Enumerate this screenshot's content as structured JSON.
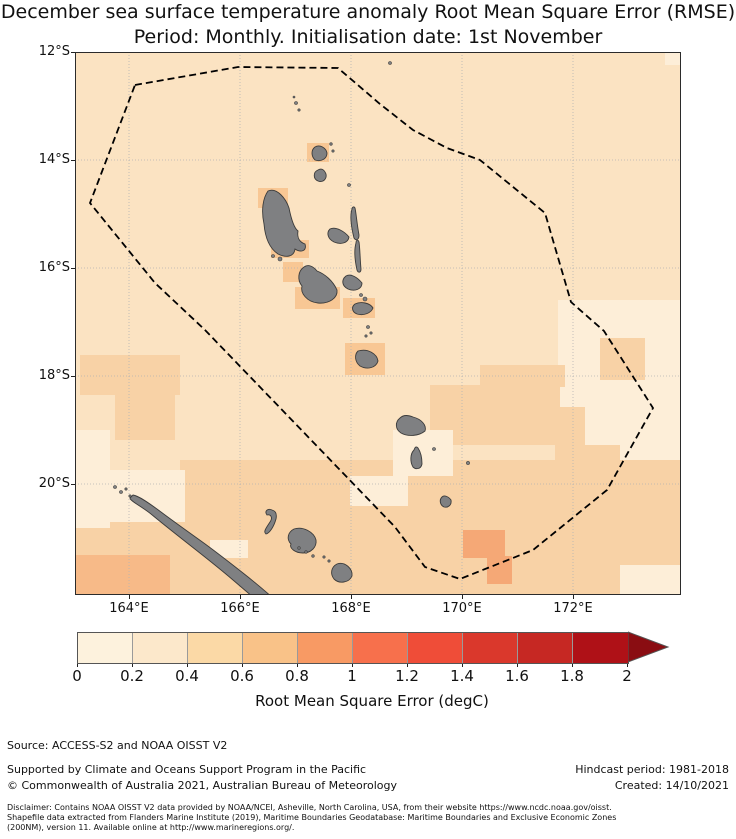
{
  "title": {
    "line1": "December sea surface temperature anomaly Root Mean Square Error (RMSE)",
    "line2": "Period: Monthly. Initialisation date: 1st November"
  },
  "footer": {
    "source": "Source: ACCESS-S2 and NOAA OISST V2",
    "supported": "Supported by Climate and Oceans Support Program in the Pacific",
    "copyright": "© Commonwealth of Australia 2021, Australian Bureau of Meteorology",
    "hindcast": "Hindcast period: 1981-2018",
    "created": "Created: 14/10/2021",
    "disclaimer_line1": "Disclaimer: Contains NOAA OISST V2 data provided by NOAA/NCEI, Asheville, North Carolina, USA, from their website https://www.ncdc.noaa.gov/oisst.",
    "disclaimer_line2": "Shapefile data extracted from Flanders Marine Institute (2019), Maritime Boundaries Geodatabase: Maritime Boundaries and Exclusive Economic Zones",
    "disclaimer_line3": "(200NM), version 11. Available online at http://www.marineregions.org/."
  },
  "chart_data": {
    "type": "heatmap",
    "subtype": "geographic-rmse-map",
    "title": "December sea surface temperature anomaly Root Mean Square Error (RMSE)",
    "subtitle": "Period: Monthly. Initialisation date: 1st November",
    "x_ticks": [
      "164°E",
      "166°E",
      "168°E",
      "170°E",
      "172°E"
    ],
    "y_ticks": [
      "12°S",
      "14°S",
      "16°S",
      "18°S",
      "20°S"
    ],
    "xlim": [
      "163°E",
      "174°E"
    ],
    "ylim": [
      "22°S",
      "12°S"
    ],
    "grid": true,
    "boundary": "dashed black EEZ polygon",
    "colorbar": {
      "label": "Root Mean Square Error (degC)",
      "ticks": [
        "0",
        "0.2",
        "0.4",
        "0.6",
        "0.8",
        "1",
        "1.2",
        "1.4",
        "1.6",
        "1.8",
        "2"
      ],
      "bin_colors": [
        "#fdf2dd",
        "#fce8cb",
        "#fbd9a6",
        "#f9c288",
        "#f89a64",
        "#f7704c",
        "#ef4d38",
        "#da382c",
        "#c62823",
        "#af1117"
      ],
      "arrow_color": "#8a0d12",
      "extend": "max"
    },
    "field_summary": [
      {
        "region": "most of map (ocean around Vanuatu)",
        "rmse_bin": "0.2-0.4"
      },
      {
        "region": "east of EEZ boundary and scattered coastal cells",
        "rmse_bin": "0-0.2"
      },
      {
        "region": "southern third of map, west 18S cluster, central 18-19.5S region",
        "rmse_bin": "0.4-0.6"
      },
      {
        "region": "grid cells hugging the main islands",
        "rmse_bin": "0.6-0.8"
      },
      {
        "region": "small patch near 170.5E 21S",
        "rmse_bin": "0.8-1"
      }
    ]
  },
  "map_geometry": {
    "units": "pixels inside 606x543 map box (origin at page 75,52)",
    "base_color": "#fbe3c2",
    "island_fill": "#7f8082",
    "island_stroke": "#3b3b3b",
    "grid_color": "#b3b3b3",
    "border_color": "#2b2b2b",
    "eez_color": "#000000",
    "gridlines": {
      "x": [
        54,
        165,
        276,
        387,
        498
      ],
      "y": [
        108,
        216,
        324,
        432
      ]
    },
    "xtick_px": [
      129,
      240,
      351,
      462,
      573
    ],
    "ytick_px": [
      52,
      160,
      268,
      376,
      484
    ],
    "eez_boundary": [
      [
        60,
        33
      ],
      [
        163,
        15
      ],
      [
        263,
        16
      ],
      [
        305,
        52
      ],
      [
        338,
        78
      ],
      [
        372,
        96
      ],
      [
        405,
        108
      ],
      [
        470,
        161
      ],
      [
        496,
        250
      ],
      [
        529,
        279
      ],
      [
        578,
        356
      ],
      [
        532,
        438
      ],
      [
        458,
        498
      ],
      [
        385,
        527
      ],
      [
        350,
        515
      ],
      [
        320,
        475
      ],
      [
        130,
        278
      ],
      [
        80,
        231
      ],
      [
        15,
        151
      ]
    ],
    "patches": [
      {
        "name": "cream-east-of-eez",
        "x": 483,
        "y": 248,
        "w": 123,
        "h": 175,
        "color": "#fdeed8",
        "bin": "0-0.2"
      },
      {
        "name": "band-south",
        "x": 0,
        "y": 448,
        "w": 606,
        "h": 95,
        "color": "#f8d2a6",
        "bin": "0.4-0.6"
      },
      {
        "name": "band-south-upper",
        "x": 105,
        "y": 408,
        "w": 501,
        "h": 40,
        "color": "#f8d2a6",
        "bin": "0.4-0.6"
      },
      {
        "name": "central-eez-patch",
        "x": 355,
        "y": 333,
        "w": 130,
        "h": 60,
        "color": "#f8d2a6",
        "bin": "0.4-0.6"
      },
      {
        "name": "central-eez-patch-top",
        "x": 405,
        "y": 313,
        "w": 85,
        "h": 22,
        "color": "#f8d2a6",
        "bin": "0.4-0.6"
      },
      {
        "name": "west-cluster-a",
        "x": 5,
        "y": 303,
        "w": 100,
        "h": 40,
        "color": "#f8d2a6",
        "bin": "0.4-0.6"
      },
      {
        "name": "west-cluster-b",
        "x": 40,
        "y": 338,
        "w": 60,
        "h": 50,
        "color": "#f8d2a6",
        "bin": "0.4-0.6"
      },
      {
        "name": "east-patch-17s",
        "x": 525,
        "y": 286,
        "w": 45,
        "h": 42,
        "color": "#f8d2a6",
        "bin": "0.4-0.6"
      },
      {
        "name": "east-step-a",
        "x": 480,
        "y": 355,
        "w": 30,
        "h": 88,
        "color": "#f8d2a6",
        "bin": "0.4-0.6"
      },
      {
        "name": "east-step-b",
        "x": 510,
        "y": 393,
        "w": 35,
        "h": 50,
        "color": "#f8d2a6",
        "bin": "0.4-0.6"
      },
      {
        "name": "cream-west-edge",
        "x": 0,
        "y": 378,
        "w": 35,
        "h": 98,
        "color": "#fdeed8",
        "bin": "0-0.2"
      },
      {
        "name": "cream-nw-new-caledonia",
        "x": 35,
        "y": 418,
        "w": 75,
        "h": 52,
        "color": "#fdeed8",
        "bin": "0-0.2"
      },
      {
        "name": "cream-south-erromango",
        "x": 318,
        "y": 378,
        "w": 60,
        "h": 46,
        "color": "#fdeed8",
        "bin": "0-0.2"
      },
      {
        "name": "cream-south-erromango-b",
        "x": 275,
        "y": 424,
        "w": 58,
        "h": 30,
        "color": "#fdeed8",
        "bin": "0-0.2"
      },
      {
        "name": "cream-bottom-right",
        "x": 545,
        "y": 513,
        "w": 61,
        "h": 30,
        "color": "#fdeed8",
        "bin": "0-0.2"
      },
      {
        "name": "cream-near-nc",
        "x": 135,
        "y": 488,
        "w": 38,
        "h": 18,
        "color": "#fdeed8",
        "bin": "0-0.2"
      },
      {
        "name": "cream-top-right",
        "x": 590,
        "y": 0,
        "w": 16,
        "h": 13,
        "color": "#fdeed8",
        "bin": "0-0.2"
      },
      {
        "name": "orange-south-tanna-a",
        "x": 388,
        "y": 478,
        "w": 42,
        "h": 28,
        "color": "#f5a876",
        "bin": "0.8-1"
      },
      {
        "name": "orange-south-tanna-b",
        "x": 412,
        "y": 504,
        "w": 25,
        "h": 28,
        "color": "#f5a876",
        "bin": "0.8-1"
      },
      {
        "name": "orange-bottom-left",
        "x": 0,
        "y": 503,
        "w": 95,
        "h": 40,
        "color": "#f7ba88",
        "bin": "0.6-0.8"
      },
      {
        "name": "cell-vanua-lava",
        "x": 232,
        "y": 91,
        "w": 22,
        "h": 19,
        "color": "#f8c794",
        "bin": "0.6-0.8"
      },
      {
        "name": "cell-santo-nw",
        "x": 183,
        "y": 136,
        "w": 30,
        "h": 20,
        "color": "#f8c794",
        "bin": "0.6-0.8"
      },
      {
        "name": "cell-santo-s",
        "x": 196,
        "y": 188,
        "w": 38,
        "h": 18,
        "color": "#f8c794",
        "bin": "0.6-0.8"
      },
      {
        "name": "cell-malakula-w",
        "x": 208,
        "y": 210,
        "w": 20,
        "h": 20,
        "color": "#f8c794",
        "bin": "0.6-0.8"
      },
      {
        "name": "cell-malakula-s",
        "x": 220,
        "y": 235,
        "w": 45,
        "h": 22,
        "color": "#f8c794",
        "bin": "0.6-0.8"
      },
      {
        "name": "cell-epi",
        "x": 268,
        "y": 246,
        "w": 32,
        "h": 20,
        "color": "#f8c794",
        "bin": "0.6-0.8"
      },
      {
        "name": "cell-efate",
        "x": 270,
        "y": 291,
        "w": 40,
        "h": 32,
        "color": "#f8c794",
        "bin": "0.6-0.8"
      }
    ],
    "islands": [
      {
        "name": "vanua-lava",
        "d": "M240,95 C236,98 236,104 240,108 C246,110 252,107 252,101 C251,96 245,92 240,95 Z"
      },
      {
        "name": "gaua",
        "d": "M243,118 C238,120 238,127 243,129 C248,131 252,127 251,122 C249,117 246,116 243,118 Z"
      },
      {
        "name": "espiritu-santo",
        "d": "M193,139 C188,146 186,158 189,172 C190,184 194,196 203,202 C211,206 219,205 220,197 C226,201 232,199 230,192 C224,190 222,185 223,179 C219,176 216,166 214,156 C211,147 202,135 193,139 Z"
      },
      {
        "name": "ambae",
        "d": "M255,177 C251,181 253,187 259,190 C266,193 273,191 274,185 C270,180 261,174 255,177 Z"
      },
      {
        "name": "maewo",
        "d": "M277,157 C275,163 276,174 279,186 C281,189 284,188 284,183 C282,172 281,160 280,156 C279,154 277,155 277,157 Z"
      },
      {
        "name": "pentecost",
        "d": "M281,191 C279,198 280,209 282,218 C283,221 286,221 286,217 C285,207 285,196 284,190 C283,187 281,188 281,191 Z"
      },
      {
        "name": "malakula",
        "d": "M229,215 C223,219 222,228 227,234 C225,241 232,250 243,251 C254,252 263,246 262,238 C258,229 250,222 242,219 C238,214 233,212 229,215 Z"
      },
      {
        "name": "ambrym",
        "d": "M271,224 C266,228 267,234 273,237 C280,240 287,237 287,231 C283,226 276,221 271,224 Z"
      },
      {
        "name": "epi",
        "d": "M280,252 C276,255 277,260 282,262 C289,264 296,261 298,256 C295,251 286,249 280,252 Z"
      },
      {
        "name": "efate",
        "d": "M283,299 C279,303 280,310 285,314 C292,318 301,316 303,309 C302,302 293,296 283,299 Z"
      },
      {
        "name": "erromango",
        "d": "M325,366 C320,370 320,377 326,381 C333,385 344,384 350,379 C352,373 346,367 338,365 C333,363 328,363 325,366 Z"
      },
      {
        "name": "tanna",
        "d": "M339,398 C335,402 335,410 338,415 C341,418 346,417 347,412 C347,405 345,399 343,396 C341,394 340,395 339,398 Z"
      },
      {
        "name": "aneityum",
        "d": "M367,445 C364,448 365,453 369,455 C373,456 377,453 376,448 C373,444 369,443 367,445 Z"
      },
      {
        "name": "new-caledonia",
        "d": "M58,443 C64,444 74,451 86,460 C98,469 112,479 126,489 C140,499 154,510 168,521 C182,532 196,544 208,555 L212,560 L198,562 C186,552 172,540 158,528 C144,516 130,505 116,494 C102,483 88,472 76,462 C66,454 55,449 55,446 Z"
      },
      {
        "name": "ouvea",
        "d": "M197,458 C193,456 189,459 192,463 C196,462 198,466 195,470 C191,476 188,480 191,482 C195,481 199,474 201,467 C202,462 201,459 197,458 Z"
      },
      {
        "name": "lifou",
        "d": "M219,477 C213,480 211,487 216,492 C214,496 220,501 228,501 C236,501 242,495 241,488 C239,480 228,474 219,477 Z"
      },
      {
        "name": "mare",
        "d": "M262,512 C256,515 255,522 259,527 C264,532 274,531 277,524 C278,517 270,509 262,512 Z"
      },
      {
        "name": "torres-islet-a",
        "cx": 221,
        "cy": 51,
        "r": 1.5
      },
      {
        "name": "torres-islet-b",
        "cx": 224,
        "cy": 58,
        "r": 1.2
      },
      {
        "name": "torres-islet-c",
        "cx": 219,
        "cy": 45,
        "r": 1.0
      },
      {
        "name": "hiu-islet",
        "cx": 315,
        "cy": 11,
        "r": 1.5
      },
      {
        "name": "mota-lava-a",
        "cx": 256,
        "cy": 92,
        "r": 1.3
      },
      {
        "name": "mota-lava-b",
        "cx": 258,
        "cy": 99,
        "r": 1.2
      },
      {
        "name": "mere-lava",
        "cx": 274,
        "cy": 133,
        "r": 1.5
      },
      {
        "name": "malo-a",
        "cx": 205,
        "cy": 207,
        "r": 2
      },
      {
        "name": "malo-b",
        "cx": 198,
        "cy": 204,
        "r": 1.5
      },
      {
        "name": "paama",
        "cx": 286,
        "cy": 243,
        "r": 1.5
      },
      {
        "name": "lopevi",
        "cx": 290,
        "cy": 247,
        "r": 2
      },
      {
        "name": "shepherd-a",
        "cx": 293,
        "cy": 275,
        "r": 1.5
      },
      {
        "name": "shepherd-b",
        "cx": 296,
        "cy": 281,
        "r": 1.2
      },
      {
        "name": "shepherd-c",
        "cx": 291,
        "cy": 284,
        "r": 1.2
      },
      {
        "name": "aniwa",
        "cx": 359,
        "cy": 397,
        "r": 1.5
      },
      {
        "name": "futuna",
        "cx": 393,
        "cy": 411,
        "r": 1.6
      },
      {
        "name": "nc-nw-islet-a",
        "cx": 40,
        "cy": 435,
        "r": 1.5
      },
      {
        "name": "nc-nw-islet-b",
        "cx": 46,
        "cy": 440,
        "r": 1.5
      },
      {
        "name": "nc-nw-islet-c",
        "cx": 51,
        "cy": 437,
        "r": 1.2
      },
      {
        "name": "nc-nw-islet-d",
        "cx": 55,
        "cy": 444,
        "r": 1.2
      },
      {
        "name": "nc-east-islet-a",
        "cx": 224,
        "cy": 496,
        "r": 1.3
      },
      {
        "name": "nc-east-islet-b",
        "cx": 231,
        "cy": 500,
        "r": 1.3
      },
      {
        "name": "nc-east-islet-c",
        "cx": 238,
        "cy": 504,
        "r": 1.3
      },
      {
        "name": "loyalty-islet-a",
        "cx": 249,
        "cy": 505,
        "r": 1.2
      },
      {
        "name": "loyalty-islet-b",
        "cx": 254,
        "cy": 509,
        "r": 1.2
      }
    ]
  },
  "colorbar_layout": {
    "left": 77,
    "top": 632,
    "seg_width": 55,
    "height": 30,
    "arrow_width": 40
  }
}
